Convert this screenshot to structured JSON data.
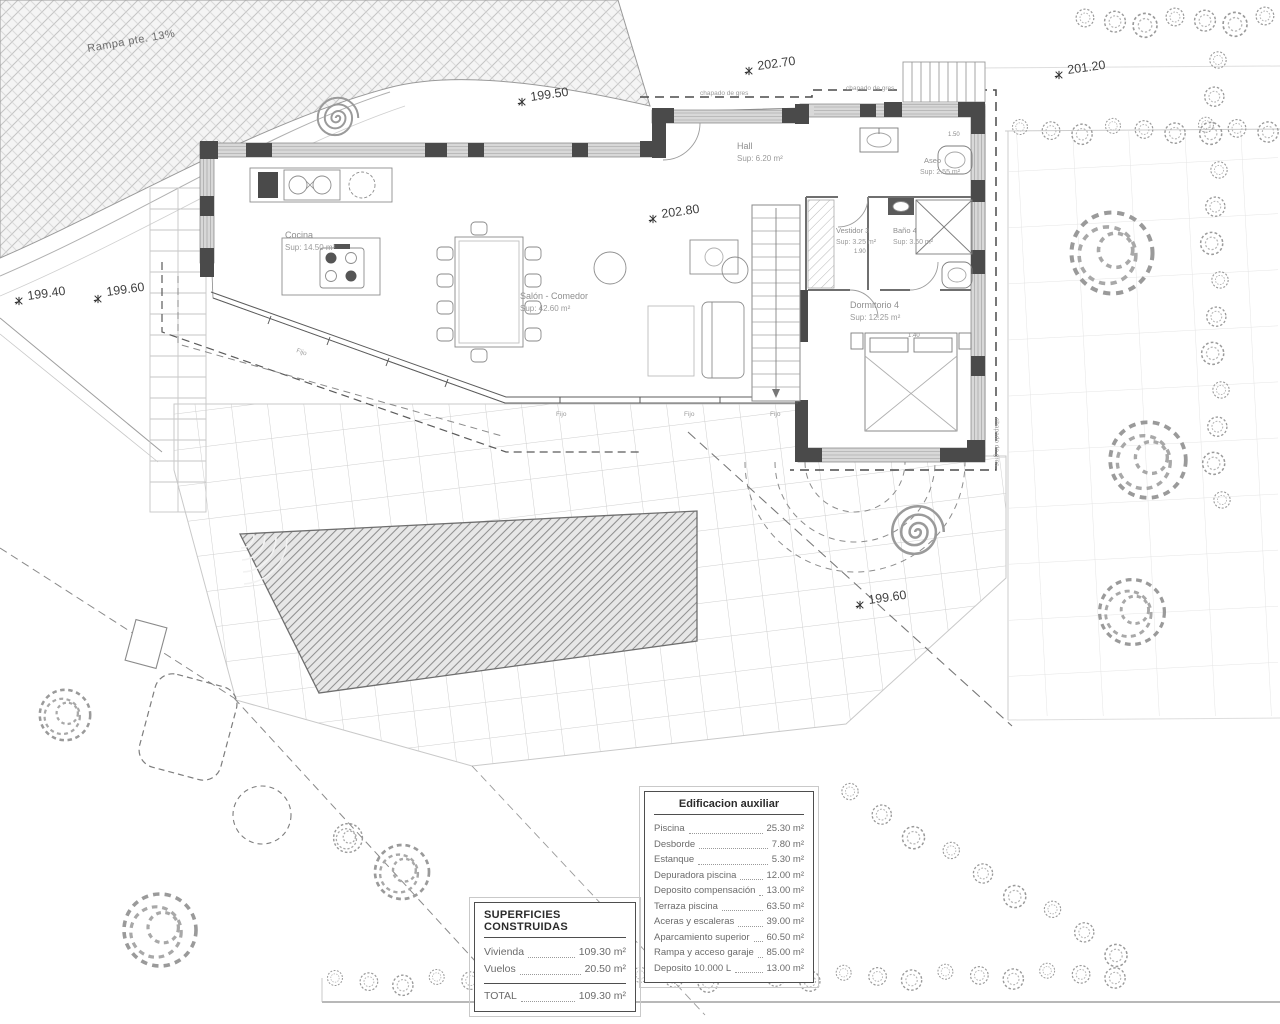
{
  "plan": {
    "ramp_label": "Rampa pte. 13%",
    "finish_label": "chapado de gres",
    "window_label": "Fijo",
    "dims": [
      "1.50",
      "1.90",
      "1.40"
    ],
    "rooms": [
      {
        "name": "Cocina",
        "sup": "Sup: 14.50 m²"
      },
      {
        "name": "Salón - Comedor",
        "sup": "Sup: 42.60 m²"
      },
      {
        "name": "Hall",
        "sup": "Sup: 6.20 m²"
      },
      {
        "name": "Aseo",
        "sup": "Sup: 2.55 m²"
      },
      {
        "name": "Vestidor 3",
        "sup": "Sup: 3.25 m²"
      },
      {
        "name": "Baño 4",
        "sup": "Sup: 3.60 m²"
      },
      {
        "name": "Dormitorio 4",
        "sup": "Sup: 12.25 m²"
      }
    ],
    "elevations": [
      "199.50",
      "202.70",
      "201.20",
      "199.40",
      "199.60",
      "202.80",
      "199.60"
    ]
  },
  "superficies_table": {
    "title": "SUPERFICIES CONSTRUIDAS",
    "rows": [
      {
        "label": "Vivienda",
        "value": "109.30 m²"
      },
      {
        "label": "Vuelos",
        "value": "20.50 m²"
      }
    ],
    "total": {
      "label": "TOTAL",
      "value": "109.30 m²"
    }
  },
  "aux_table": {
    "title": "Edificacion auxiliar",
    "rows": [
      {
        "label": "Piscina",
        "value": "25.30 m²"
      },
      {
        "label": "Desborde",
        "value": "7.80 m²"
      },
      {
        "label": "Estanque",
        "value": "5.30 m²"
      },
      {
        "label": "Depuradora piscina",
        "value": "12.00 m²"
      },
      {
        "label": "Deposito compensación",
        "value": "13.00 m²"
      },
      {
        "label": "Terraza piscina",
        "value": "63.50 m²"
      },
      {
        "label": "Aceras y escaleras",
        "value": "39.00 m²"
      },
      {
        "label": "Aparcamiento superior",
        "value": "60.50 m²"
      },
      {
        "label": "Rampa y acceso garaje",
        "value": "85.00 m²"
      },
      {
        "label": "Deposito 10.000 L",
        "value": "13.00 m²"
      }
    ]
  }
}
